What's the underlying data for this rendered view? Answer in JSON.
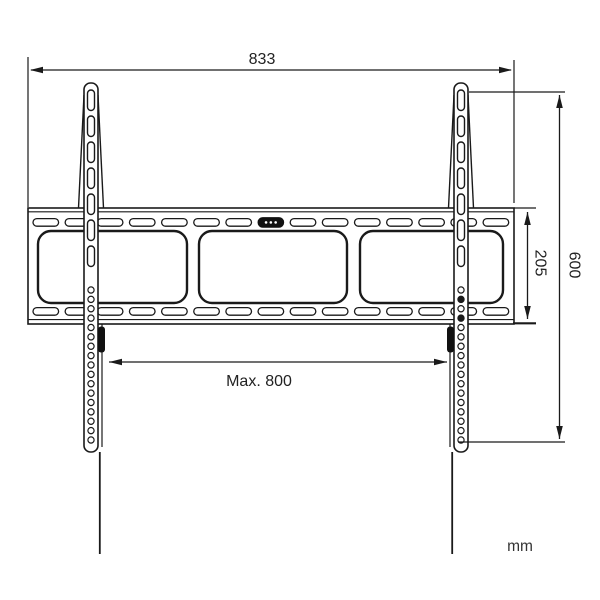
{
  "drawing": {
    "units_label": "mm",
    "dimension_labels": {
      "plate_width": "833",
      "overall_height": "600",
      "plate_height": "205",
      "max_mount_width": "Max. 800"
    },
    "colors": {
      "line": "#1a1a1a",
      "background": "#ffffff",
      "accent_fill": "#111111"
    },
    "structure": {
      "wall_plate": {
        "cutout_count": 3,
        "slot_rows": 2,
        "slots_per_row": 15,
        "level_slot_index": 7
      },
      "arms": {
        "count": 2,
        "vertical_slots_per_arm": 7,
        "round_holes_per_arm": 17
      }
    }
  }
}
